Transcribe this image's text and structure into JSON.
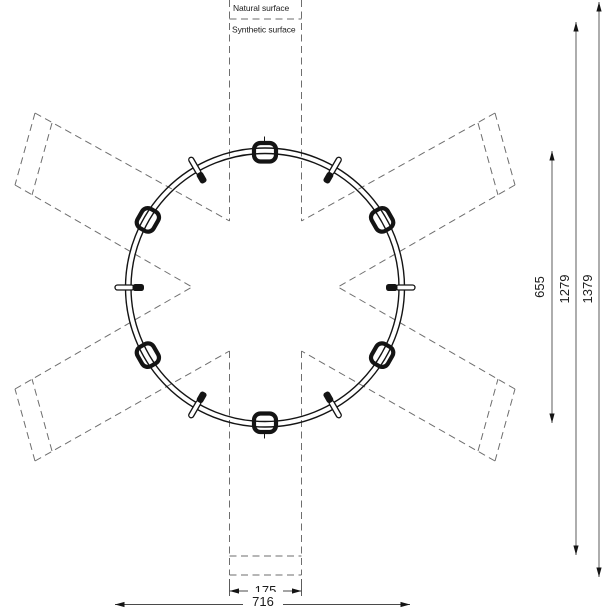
{
  "drawing": {
    "type": "top-view technical drawing of circular roundabout play equipment with access lanes",
    "surface_labels": {
      "natural": "Natural surface",
      "synthetic": "Synthetic surface"
    },
    "dimensions": {
      "right": [
        {
          "id": "dim-655",
          "value": "655"
        },
        {
          "id": "dim-1279",
          "value": "1279"
        },
        {
          "id": "dim-1379",
          "value": "1379"
        }
      ],
      "bottom": [
        {
          "id": "dim-175",
          "value": "175"
        },
        {
          "id": "dim-716",
          "value": "716"
        }
      ]
    },
    "colors": {
      "background": "#ffffff",
      "solid": "#141414",
      "dashed": "#6e6e6e",
      "dimension": "#4a4a4a"
    }
  }
}
